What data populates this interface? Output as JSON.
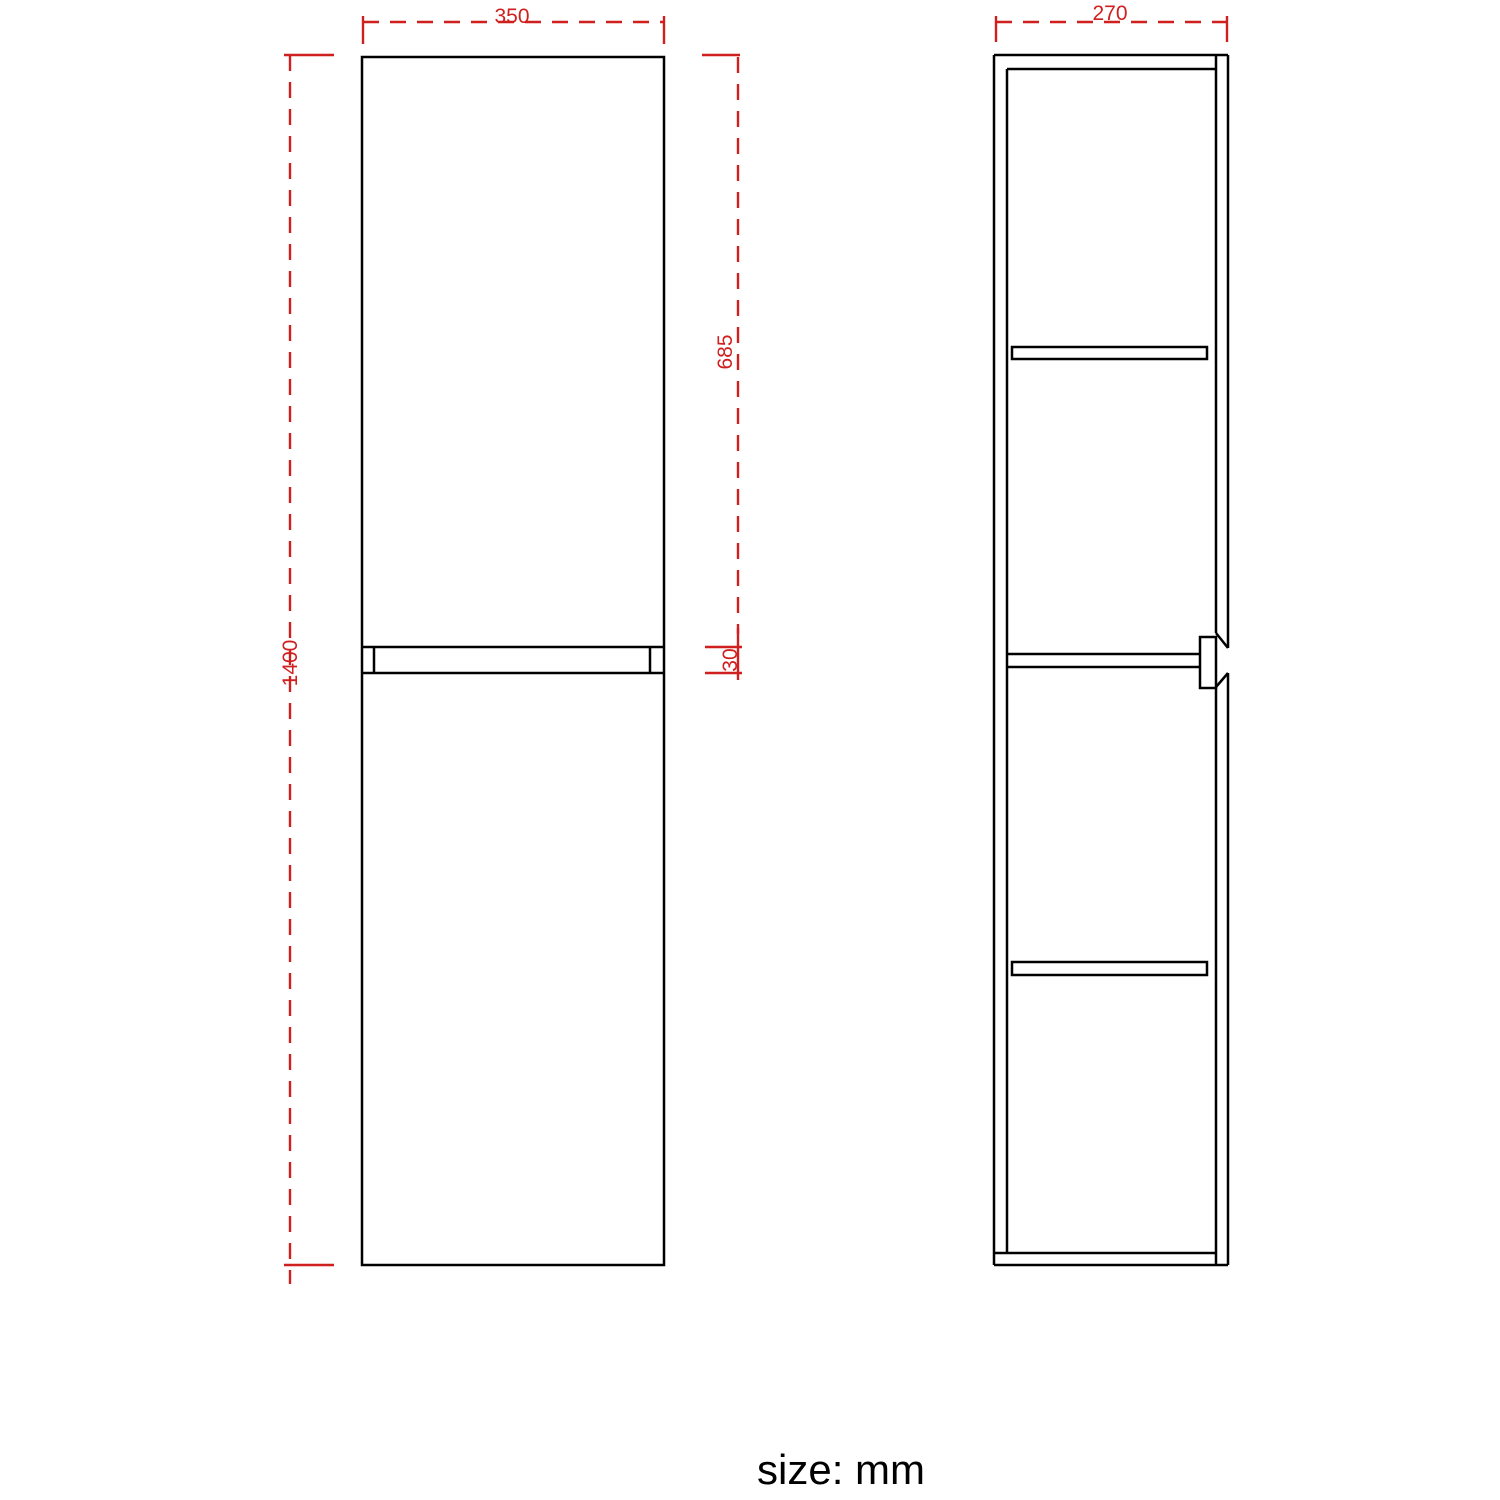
{
  "colors": {
    "outline": "#000000",
    "dimension": "#d01f1f"
  },
  "front_view": {
    "dim_width_mm": "350",
    "dim_height_mm": "1400",
    "dim_upper_door_mm": "685",
    "dim_gap_mm": "30"
  },
  "side_view": {
    "dim_depth_mm": "270"
  },
  "footer": {
    "unit_label": "size: mm"
  }
}
